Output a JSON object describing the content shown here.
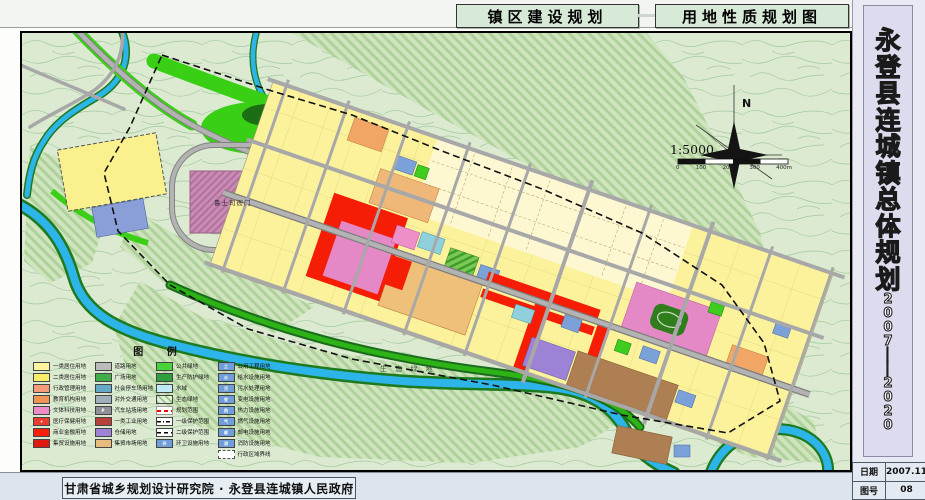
{
  "header": {
    "tab1": "镇区建设规划",
    "tab2": "用地性质规划图"
  },
  "sidebar": {
    "title_chars": [
      "永",
      "登",
      "县",
      "连",
      "城",
      "镇",
      "总",
      "体",
      "规",
      "划"
    ],
    "year_chars": [
      "2",
      "0",
      "0",
      "7",
      "│",
      "│",
      "2",
      "0",
      "2",
      "0"
    ],
    "date_label": "日期",
    "date_value": "2007.11",
    "figno_label": "图号",
    "figno_value": "08"
  },
  "footer": {
    "credit": "甘肃省城乡规划设计研究院 · 永登县连城镇人民政府"
  },
  "map": {
    "labels": {
      "yamen": "鲁土司衙门",
      "eco": "生 态 绿 地"
    },
    "compass": {
      "north": "N",
      "scale_text": "1:5000",
      "scalebar_labels": [
        "0",
        "100",
        "200",
        "300",
        "400m"
      ]
    },
    "legend": {
      "title": "图 例",
      "columns": [
        {
          "items": [
            {
              "label": "一类居住用地",
              "color": "#fdf69e"
            },
            {
              "label": "二类居住用地",
              "color": "#f9ee6a"
            },
            {
              "label": "行政管理用地",
              "color": "#f59d78"
            },
            {
              "label": "教育机构用地",
              "color": "#ef9455"
            },
            {
              "label": "文体科技用地",
              "color": "#ee8cc8"
            },
            {
              "label": "医疗保健用地",
              "color": "#e93c2f",
              "mark": "+"
            },
            {
              "label": "商业金融用地",
              "color": "#f61e06"
            },
            {
              "label": "集贸设施用地",
              "color": "#df1a10"
            }
          ]
        },
        {
          "items": [
            {
              "label": "道路用地",
              "color": "#b9bcb9"
            },
            {
              "label": "广场用地",
              "color": "#3fae4a"
            },
            {
              "label": "社会停车场用地",
              "color": "#64a9c8"
            },
            {
              "label": "对外交通用地",
              "color": "#9fb0bc"
            },
            {
              "label": "汽车站场用地",
              "color": "#8e9296",
              "mark": "P"
            },
            {
              "label": "一类工业用地",
              "color": "#b5413a"
            },
            {
              "label": "仓储用地",
              "color": "#9d83d6"
            },
            {
              "label": "集贸市场用地",
              "color": "#e8bc7e"
            }
          ]
        },
        {
          "items": [
            {
              "label": "公共绿地",
              "color": "#46d438"
            },
            {
              "label": "生产防护绿地",
              "color": "#2f9e3f"
            },
            {
              "label": "水域",
              "color": "#bfe9f5"
            },
            {
              "label": "生态绿地",
              "type": "hatchfill"
            },
            {
              "label": "规划范围",
              "type": "redline"
            },
            {
              "label": "一级保护范围",
              "type": "dashdot"
            },
            {
              "label": "二级保护范围",
              "type": "dash"
            },
            {
              "label": "环卫设施用地",
              "color": "#6f9ed9",
              "mark": "环"
            }
          ]
        },
        {
          "items": [
            {
              "label": "公用工程用地",
              "color": "#6f9ed9",
              "mark": "工"
            },
            {
              "label": "给水设施用地",
              "color": "#6f9ed9",
              "mark": "水"
            },
            {
              "label": "污水处理用地",
              "color": "#6f9ed9",
              "mark": "污"
            },
            {
              "label": "变电设施用地",
              "color": "#6f9ed9",
              "mark": "变"
            },
            {
              "label": "热力设施用地",
              "color": "#6f9ed9",
              "mark": "热"
            },
            {
              "label": "燃气设施用地",
              "color": "#6f9ed9",
              "mark": "气"
            },
            {
              "label": "邮电设施用地",
              "color": "#6f9ed9",
              "mark": "邮"
            },
            {
              "label": "消防设施用地",
              "color": "#6f9ed9",
              "mark": "消"
            },
            {
              "label": "行政区域界线",
              "type": "boundary"
            }
          ]
        }
      ]
    }
  }
}
